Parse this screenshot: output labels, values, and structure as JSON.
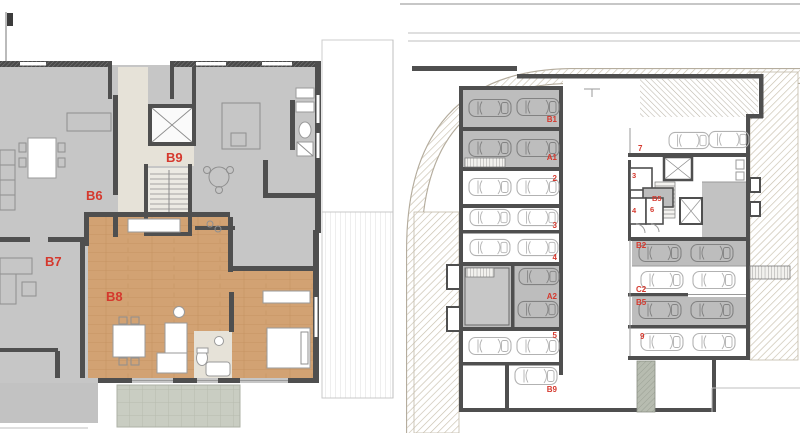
{
  "figure": {
    "kind": "architectural floor plans",
    "left_plan_description": "residential floor plan with highlighted unit",
    "right_plan_description": "basement parking / garage plan"
  },
  "colors": {
    "label_red": "#d5382d",
    "wood_floor": "#d2a273",
    "unit_gray": "#c6c6c6",
    "wall_dark": "#4f4f4f",
    "hatch_beige": "#c9c0ae"
  },
  "left_plan": {
    "units": {
      "b6": "B6",
      "b7": "B7",
      "b8": "B8",
      "b9": "B9"
    },
    "highlighted_unit": "B8"
  },
  "right_plan": {
    "stalls_left": {
      "b1": "B1",
      "a1": "A1",
      "n2": "2",
      "n3": "3",
      "n4": "4",
      "a2": "A2",
      "n5": "5",
      "b9": "B9"
    },
    "stalls_right": {
      "n7": "7",
      "b2": "B2",
      "c2": "C2",
      "b5": "B5",
      "n9": "9"
    },
    "storerooms": {
      "n3": "3",
      "b5": "B5",
      "n4": "4",
      "n6": "6"
    }
  }
}
